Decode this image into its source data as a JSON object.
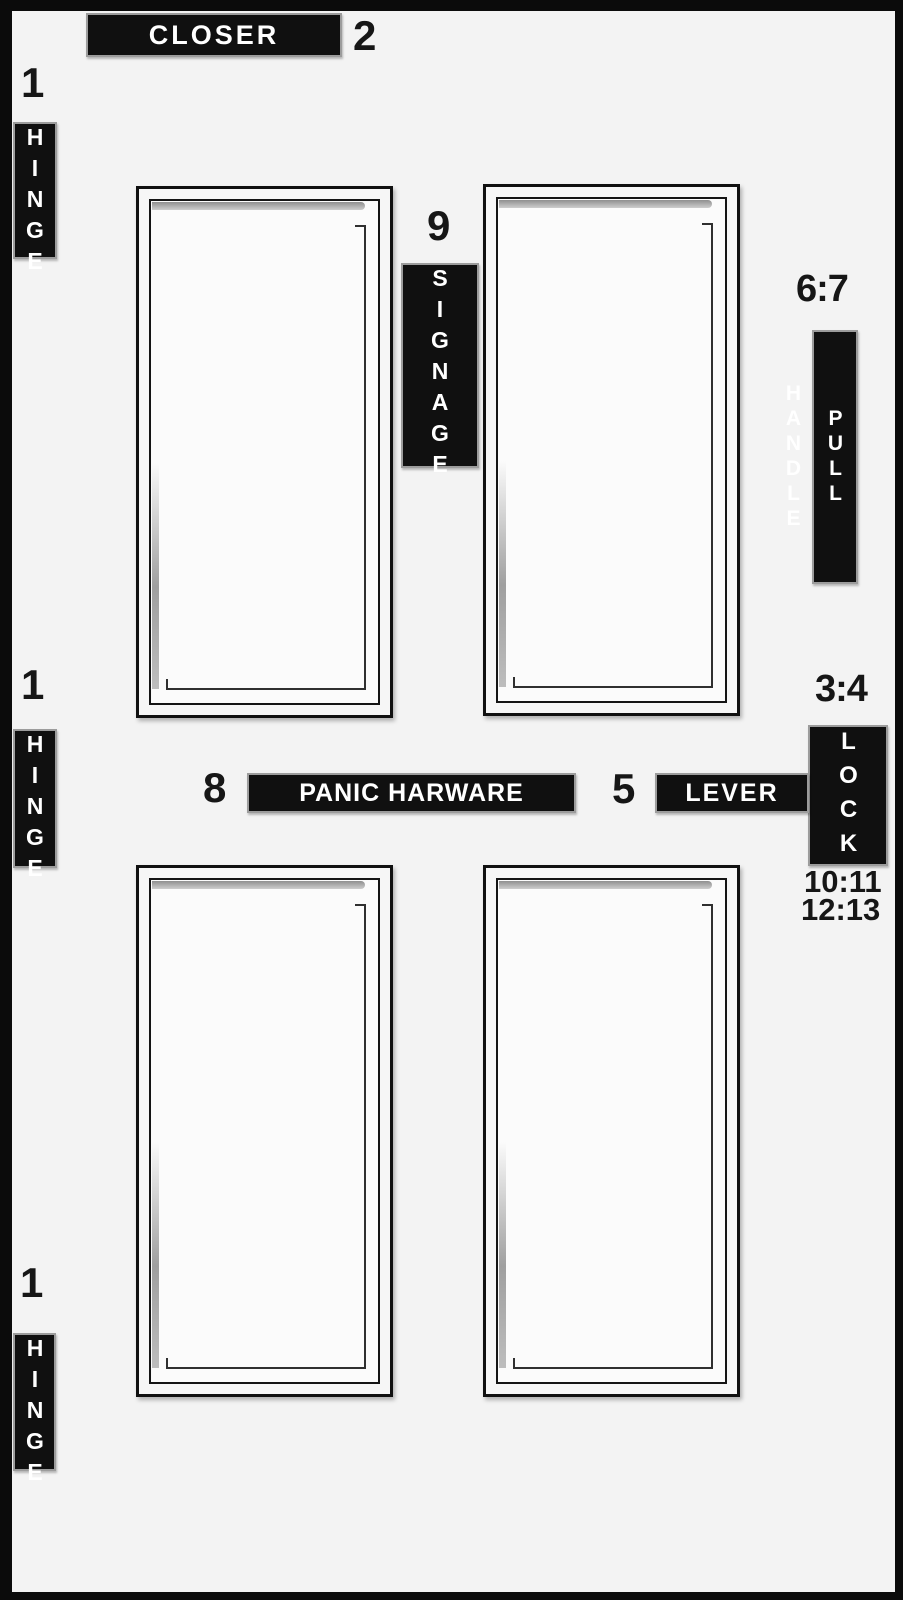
{
  "diagram": {
    "background": "#f3f3f3",
    "border_color": "#0b0b0b",
    "label_bg": "#101010",
    "label_text_color": "#ffffff",
    "number_color": "#161616"
  },
  "annotations": {
    "closer": {
      "number": "2",
      "label": "CLOSER"
    },
    "hinge_top": {
      "number": "1",
      "label": "HINGE"
    },
    "hinge_middle": {
      "number": "1",
      "label": "HINGE"
    },
    "hinge_bottom": {
      "number": "1",
      "label": "HINGE"
    },
    "signage": {
      "number": "9",
      "label": "SIGNAGE"
    },
    "pull_handle": {
      "number": "6:7",
      "label": "PULL HANDLE"
    },
    "lock": {
      "number": "3:4",
      "label": "LOCK",
      "numbers_below": [
        "10:11",
        "12:13"
      ]
    },
    "panic_hardware": {
      "number": "8",
      "label": "PANIC HARWARE"
    },
    "lever": {
      "number": "5",
      "label": "LEVER"
    }
  }
}
